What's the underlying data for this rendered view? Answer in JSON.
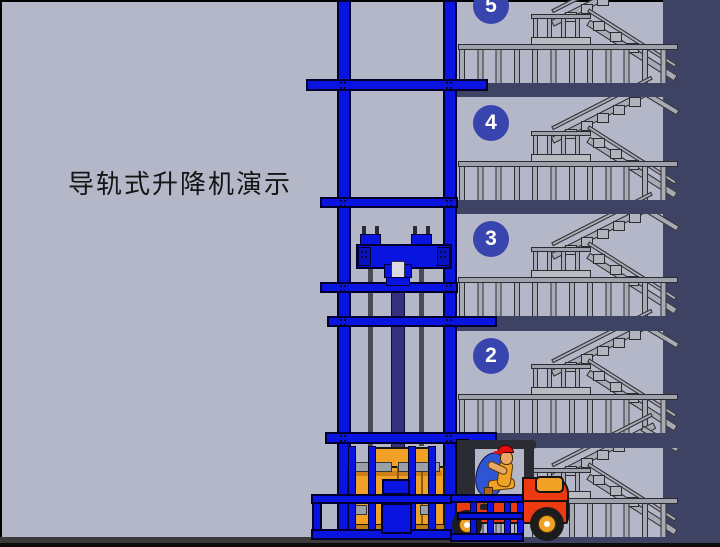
{
  "title": "导轨式升降机演示",
  "floors": [
    {
      "label": "5"
    },
    {
      "label": "4"
    },
    {
      "label": "3"
    },
    {
      "label": "2"
    },
    {
      "label": ""
    }
  ],
  "colors": {
    "background": "#b4b7c7",
    "rail_blue": "#0a14e0",
    "slab": "#3e4363",
    "circle_blue": "#3845ae",
    "stair_gray": "#a8aab4",
    "forklift_red": "#ee3a10",
    "cargo_orange": "#f0a126",
    "cylinder_navy": "#34317e"
  }
}
